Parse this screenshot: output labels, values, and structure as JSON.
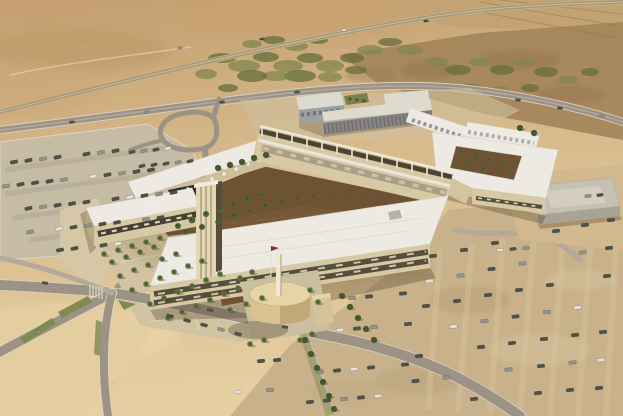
{
  "scene_label": "aerial-architectural-rendering-desert-campus",
  "palette": {
    "sand_top": "#c49e6e",
    "sand_mid": "#d8bb8d",
    "sand_low": "#e6cfa2",
    "terrain_dark": "#a4845a",
    "field": "#c2a273",
    "veg": "#83854d",
    "veg_dark": "#666d3c",
    "road": "#9c9386",
    "road_light": "#b3aa9b",
    "road_edge": "#dcd5c4",
    "lot_left": "#c6bba4",
    "lot_row": "#b2a78f",
    "lot_right": "#c8b18b",
    "lot_right_light": "#d8c49c",
    "lot_right_dark": "#b39d78",
    "pavement": "#d3c5a3",
    "path_light": "#e3d6b4",
    "roof_white": "#eceae3",
    "roof_shade": "#dddacf",
    "wall_cream": "#d6c9a4",
    "wall_cream_dark": "#c2b38c",
    "glass_dark": "#554e3d",
    "window_lit": "#d8cfb4",
    "gray_wall": "#9aa0a4",
    "gray_wall_dark": "#7d8287",
    "court_ground": "#6d5233",
    "planting_red": "#7a4a33",
    "tree": "#4f6434",
    "palm": "#5d7340",
    "palm_dark": "#3e5226",
    "hedge": "#44582e",
    "grass": "#7f8a50",
    "cylinder": "#d9c391",
    "cylinder_top": "#e7d4a4",
    "cylinder_shade": "#b39a6c",
    "car_dark": "#4a524c",
    "car_gray": "#8f948e",
    "car_white": "#e6e3d8",
    "shadow": "rgba(70,52,28,0.32)"
  },
  "scene": {
    "vegetation_patches": [
      [
        222,
        58,
        14,
        5
      ],
      [
        244,
        66,
        16,
        6
      ],
      [
        266,
        57,
        13,
        5
      ],
      [
        288,
        66,
        15,
        6
      ],
      [
        310,
        58,
        13,
        5
      ],
      [
        330,
        66,
        14,
        6
      ],
      [
        352,
        58,
        12,
        5
      ],
      [
        370,
        50,
        13,
        5
      ],
      [
        390,
        42,
        12,
        4
      ],
      [
        410,
        50,
        13,
        5
      ],
      [
        300,
        76,
        16,
        6
      ],
      [
        276,
        76,
        14,
        5
      ],
      [
        252,
        76,
        15,
        6
      ],
      [
        330,
        77,
        12,
        5
      ],
      [
        356,
        70,
        11,
        4
      ],
      [
        436,
        62,
        12,
        5
      ],
      [
        458,
        70,
        13,
        5
      ],
      [
        480,
        62,
        11,
        4
      ],
      [
        502,
        70,
        12,
        5
      ],
      [
        524,
        62,
        11,
        4
      ],
      [
        546,
        72,
        12,
        5
      ],
      [
        568,
        80,
        10,
        4
      ],
      [
        590,
        72,
        9,
        4
      ],
      [
        446,
        86,
        10,
        4
      ],
      [
        470,
        88,
        11,
        4
      ],
      [
        500,
        90,
        10,
        4
      ],
      [
        530,
        88,
        9,
        4
      ],
      [
        252,
        44,
        10,
        4
      ],
      [
        274,
        40,
        11,
        4
      ],
      [
        296,
        46,
        12,
        5
      ],
      [
        318,
        40,
        10,
        4
      ],
      [
        206,
        74,
        11,
        5
      ],
      [
        228,
        88,
        10,
        4
      ]
    ],
    "palms": [
      [
        104,
        254
      ],
      [
        118,
        250
      ],
      [
        132,
        246
      ],
      [
        146,
        242
      ],
      [
        160,
        238
      ],
      [
        112,
        262
      ],
      [
        126,
        257
      ],
      [
        140,
        252
      ],
      [
        154,
        247
      ],
      [
        120,
        276
      ],
      [
        134,
        270
      ],
      [
        148,
        265
      ],
      [
        162,
        259
      ],
      [
        176,
        254
      ],
      [
        132,
        290
      ],
      [
        146,
        284
      ],
      [
        160,
        278
      ],
      [
        174,
        272
      ],
      [
        188,
        266
      ],
      [
        202,
        261
      ],
      [
        150,
        304
      ],
      [
        164,
        298
      ],
      [
        178,
        292
      ],
      [
        192,
        286
      ],
      [
        206,
        280
      ],
      [
        220,
        274
      ],
      [
        168,
        318
      ],
      [
        182,
        312
      ],
      [
        196,
        306
      ],
      [
        210,
        300
      ],
      [
        224,
        294
      ],
      [
        238,
        288
      ],
      [
        240,
        278
      ],
      [
        252,
        272
      ],
      [
        310,
        290
      ],
      [
        318,
        302
      ],
      [
        250,
        344
      ],
      [
        264,
        340
      ],
      [
        300,
        340
      ],
      [
        312,
        334
      ],
      [
        230,
        310
      ],
      [
        246,
        304
      ],
      [
        262,
        298
      ]
    ],
    "courtyard_trees": [
      [
        178,
        226,
        3
      ],
      [
        192,
        220,
        3.4
      ],
      [
        206,
        214,
        3
      ],
      [
        220,
        209,
        3.2
      ],
      [
        234,
        204,
        2.8
      ],
      [
        248,
        199,
        3
      ],
      [
        262,
        195,
        2.6
      ],
      [
        186,
        232,
        2.6
      ],
      [
        202,
        227,
        3
      ],
      [
        218,
        222,
        2.8
      ],
      [
        234,
        216,
        3
      ],
      [
        250,
        211,
        2.6
      ],
      [
        266,
        206,
        2.8
      ],
      [
        282,
        202,
        2.4
      ],
      [
        298,
        199,
        2.2
      ],
      [
        314,
        197,
        2.4
      ],
      [
        330,
        196,
        2
      ],
      [
        348,
        197,
        2
      ],
      [
        366,
        198,
        1.8
      ],
      [
        384,
        199,
        1.8
      ],
      [
        462,
        152,
        2.2
      ],
      [
        476,
        156,
        2.4
      ],
      [
        490,
        160,
        2.2
      ],
      [
        504,
        164,
        2
      ],
      [
        468,
        164,
        2
      ],
      [
        484,
        169,
        2.2
      ],
      [
        498,
        172,
        2
      ],
      [
        350,
        99,
        1.8
      ],
      [
        357,
        100,
        1.8
      ],
      [
        364,
        101,
        1.8
      ]
    ],
    "hedge_trees": [
      [
        305,
        340
      ],
      [
        311,
        354
      ],
      [
        317,
        368
      ],
      [
        323,
        382
      ],
      [
        329,
        396
      ],
      [
        334,
        409
      ],
      [
        342,
        296
      ],
      [
        350,
        307
      ],
      [
        358,
        318
      ],
      [
        366,
        329
      ],
      [
        374,
        340
      ],
      [
        218,
        168
      ],
      [
        230,
        165
      ],
      [
        242,
        162
      ],
      [
        254,
        158
      ],
      [
        266,
        155
      ],
      [
        520,
        128
      ],
      [
        534,
        133
      ]
    ],
    "umbrellas": [
      [
        152,
        204
      ],
      [
        164,
        199
      ],
      [
        176,
        194
      ],
      [
        188,
        189
      ],
      [
        200,
        184
      ],
      [
        212,
        179
      ],
      [
        224,
        174
      ],
      [
        236,
        169
      ],
      [
        248,
        164
      ],
      [
        258,
        160
      ],
      [
        378,
        208
      ],
      [
        390,
        210
      ],
      [
        402,
        212
      ]
    ],
    "cars": {
      "color_cycle": [
        "car_dark",
        "car_dark",
        "car_gray",
        "car_dark",
        "car_white",
        "car_dark",
        "car_gray",
        "car_dark"
      ],
      "groups": [
        {
          "name": "left-lot",
          "angle": -12,
          "size": [
            7.5,
            3.4
          ],
          "sparse": true,
          "rows": [
            [
              14,
              162,
              14.5,
              -1.6,
              8
            ],
            [
              6,
              186,
              14.5,
              -1.6,
              11
            ],
            [
              14,
              210,
              14.5,
              -1.6,
              12
            ],
            [
              30,
              232,
              14.5,
              -1.6,
              10
            ],
            [
              60,
              250,
              14.5,
              -1.6,
              5
            ]
          ]
        },
        {
          "name": "right-lot",
          "angle": -6,
          "size": [
            7.5,
            3.4
          ],
          "sparse": true,
          "rows": [
            [
              433,
              256,
              -3.5,
              25,
              6
            ],
            [
              464,
              250,
              -3.5,
              25.5,
              6
            ],
            [
              495,
              243,
              -3.5,
              26,
              7
            ],
            [
              526,
              237,
              -3.5,
              26.5,
              7
            ],
            [
              556,
              231,
              -3,
              27,
              7
            ],
            [
              585,
              225,
              -2.5,
              27.5,
              7
            ],
            [
              611,
              220,
              -2,
              28,
              7
            ]
          ]
        },
        {
          "name": "right-lot-mid",
          "angle": -6,
          "size": [
            7.5,
            3.4
          ],
          "sparse": true,
          "rows": [
            [
              352,
              298,
              17,
              -1.5,
              4
            ],
            [
              340,
              330,
              17,
              -1.5,
              5
            ],
            [
              320,
              372,
              17,
              -1.5,
              6
            ],
            [
              310,
              402,
              17,
              -1.5,
              6
            ],
            [
              245,
              362,
              16,
              -1,
              3
            ],
            [
              238,
              392,
              16,
              -1,
              3
            ]
          ]
        },
        {
          "name": "loop-lot",
          "angle": -15,
          "size": [
            6.5,
            3
          ],
          "sparse": false,
          "rows": [
            [
              132,
              152,
              12,
              -1.2,
              4
            ],
            [
              142,
              166,
              12,
              -1.2,
              5
            ]
          ]
        },
        {
          "name": "warehouse-lot",
          "angle": -6,
          "size": [
            6.5,
            3
          ],
          "sparse": false,
          "rows": [
            [
              500,
              250,
              13,
              -1,
              3
            ],
            [
              588,
              196,
              12,
              -1,
              2
            ]
          ]
        },
        {
          "name": "front-road-parked",
          "angle": 14,
          "size": [
            7,
            3.2
          ],
          "sparse": false,
          "rows": [
            [
              170,
              316,
              17,
              4.5,
              5
            ]
          ]
        },
        {
          "name": "highway-traffic",
          "angle": -8,
          "size": [
            5,
            2.2
          ],
          "sparse": false,
          "rows": [
            [
              180,
              48,
              82,
              -9,
              4
            ]
          ]
        },
        {
          "name": "access-road-traffic",
          "angle": -7,
          "size": [
            5.2,
            2.4
          ],
          "sparse": false,
          "rows": [
            [
              72,
              122,
              75,
              -10,
              4
            ]
          ]
        },
        {
          "name": "road-b-traffic",
          "angle": 8,
          "size": [
            5.2,
            2.4
          ],
          "sparse": false,
          "rows": [
            [
              518,
              100,
              42,
              8,
              3
            ]
          ]
        },
        {
          "name": "front-road-traffic",
          "angle": 8,
          "size": [
            6,
            2.6
          ],
          "sparse": false,
          "rows": [
            [
              45,
              283,
              0,
              0,
              1
            ],
            [
              210,
              310,
              0,
              0,
              1
            ],
            [
              285,
              327,
              0,
              0,
              1
            ]
          ]
        },
        {
          "name": "southwest-road-traffic",
          "angle": -30,
          "size": [
            6,
            2.6
          ],
          "sparse": false,
          "rows": [
            [
              38,
              332,
              0,
              0,
              1
            ]
          ]
        }
      ]
    }
  }
}
